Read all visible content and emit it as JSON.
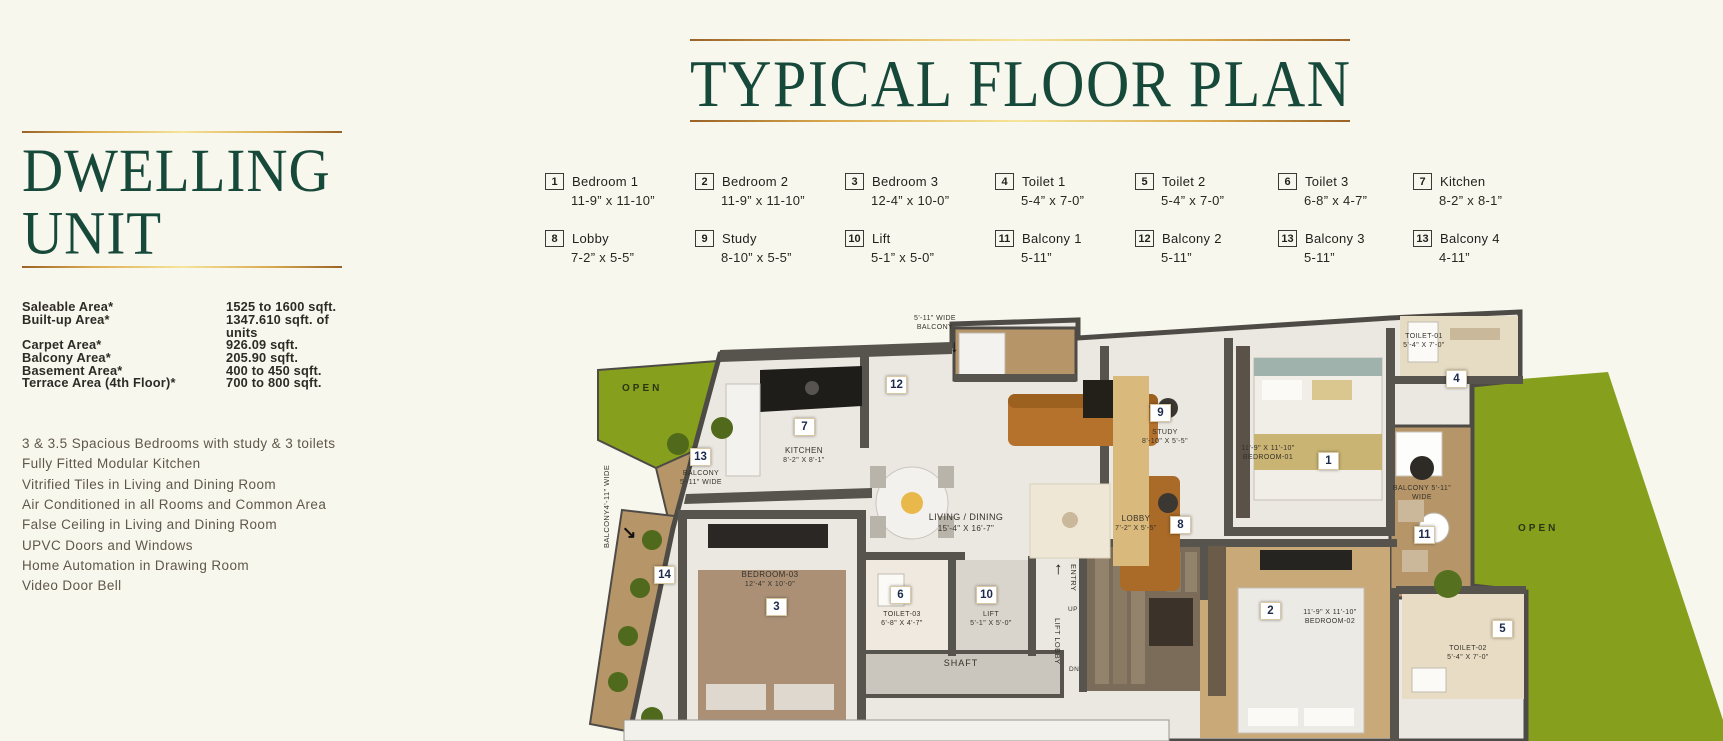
{
  "left_panel": {
    "title_line1": "DWELLING",
    "title_line2": "UNIT",
    "specs": [
      {
        "label": "Saleable Area*",
        "value": "1525 to 1600 sqft."
      },
      {
        "label": "Built-up Area*",
        "value": "1347.610 sqft. of units"
      },
      {
        "label": "Carpet Area*",
        "value": "926.09 sqft."
      },
      {
        "label": "Balcony Area*",
        "value": "205.90 sqft."
      },
      {
        "label": "Basement Area*",
        "value": "400 to 450 sqft."
      },
      {
        "label": "Terrace Area (4th Floor)*",
        "value": "700 to 800 sqft."
      }
    ],
    "features": [
      "3 & 3.5 Spacious Bedrooms with study & 3 toilets",
      "Fully Fitted Modular Kitchen",
      "Vitrified Tiles in Living and Dining Room",
      "Air Conditioned in all Rooms and Common Area",
      "False Ceiling in Living and Dining Room",
      "UPVC Doors and Windows",
      "Home Automation in Drawing Room",
      "Video Door Bell"
    ]
  },
  "header": {
    "title": "TYPICAL FLOOR PLAN"
  },
  "legend": {
    "items": [
      {
        "num": "1",
        "label": "Bedroom 1",
        "dims": "11-9” x 11-10”"
      },
      {
        "num": "2",
        "label": "Bedroom 2",
        "dims": "11-9” x 11-10”"
      },
      {
        "num": "3",
        "label": "Bedroom 3",
        "dims": "12-4” x 10-0”"
      },
      {
        "num": "4",
        "label": "Toilet 1",
        "dims": "5-4” x 7-0”"
      },
      {
        "num": "5",
        "label": "Toilet 2",
        "dims": "5-4” x 7-0”"
      },
      {
        "num": "6",
        "label": "Toilet 3",
        "dims": "6-8” x 4-7”"
      },
      {
        "num": "7",
        "label": "Kitchen",
        "dims": "8-2” x 8-1”"
      },
      {
        "num": "8",
        "label": "Lobby",
        "dims": "7-2” x 5-5”"
      },
      {
        "num": "9",
        "label": "Study",
        "dims": "8-10” x 5-5”"
      },
      {
        "num": "10",
        "label": "Lift",
        "dims": "5-1” x 5-0”"
      },
      {
        "num": "11",
        "label": "Balcony 1",
        "dims": "5-11”"
      },
      {
        "num": "12",
        "label": "Balcony 2",
        "dims": "5-11”"
      },
      {
        "num": "13",
        "label": "Balcony 3",
        "dims": "5-11”"
      },
      {
        "num": "13",
        "label": "Balcony 4",
        "dims": "4-11”"
      }
    ]
  },
  "plan": {
    "open_left": "OPEN",
    "open_right": "OPEN",
    "top_balcony": {
      "l1": "5'-11\" WIDE",
      "l2": "BALCONY",
      "badge": "12"
    },
    "balcony3": {
      "l1": "BALCONY",
      "l2": "5'-11\" WIDE",
      "badge": "13"
    },
    "balcony4": {
      "text": "BALCONY4'-11\" WIDE",
      "badge": "14"
    },
    "balcony1": {
      "l1": "BALCONY 5'-11\"",
      "l2": "WIDE",
      "badge": "11"
    },
    "kitchen": {
      "name": "KITCHEN",
      "dims": "8'-2\" X 8'-1\"",
      "badge": "7"
    },
    "living": {
      "name": "LIVING / DINING",
      "dims": "15'-4\" X 16'-7\""
    },
    "lobby": {
      "name": "LOBBY",
      "dims": "7'-2\" X 5'-5\"",
      "badge": "8"
    },
    "study": {
      "name": "STUDY",
      "dims": "8'-10\" X 5'-5\"",
      "badge": "9"
    },
    "bedroom1": {
      "name": "BEDROOM-01",
      "dims": "11'-9\" X 11'-10\"",
      "badge": "1"
    },
    "bedroom2": {
      "name": "BEDROOM-02",
      "dims": "11'-9\" X 11'-10\"",
      "badge": "2"
    },
    "bedroom3": {
      "name": "BEDROOM-03",
      "dims": "12'-4\" X 10'-0\"",
      "badge": "3"
    },
    "toilet1": {
      "name": "TOILET-01",
      "dims": "5'-4\" X 7'-0\"",
      "badge": "4"
    },
    "toilet2": {
      "name": "TOILET-02",
      "dims": "5'-4\" X 7'-0\"",
      "badge": "5"
    },
    "toilet3": {
      "name": "TOILET-03",
      "dims": "6'-8\" X 4'-7\"",
      "badge": "6"
    },
    "lift": {
      "name": "LIFT",
      "dims": "5'-1\" X 5'-0\"",
      "badge": "10"
    },
    "shaft": "SHAFT",
    "entry": "ENTRY",
    "up": "UP",
    "lift_lobby": "LIFT LOBBY",
    "dn": "DN"
  },
  "colors": {
    "accent_green": "#17493a",
    "gold": "#d9a94f",
    "lawn": "#86a01d",
    "wood": "#b69668",
    "wall": "#57544e"
  }
}
